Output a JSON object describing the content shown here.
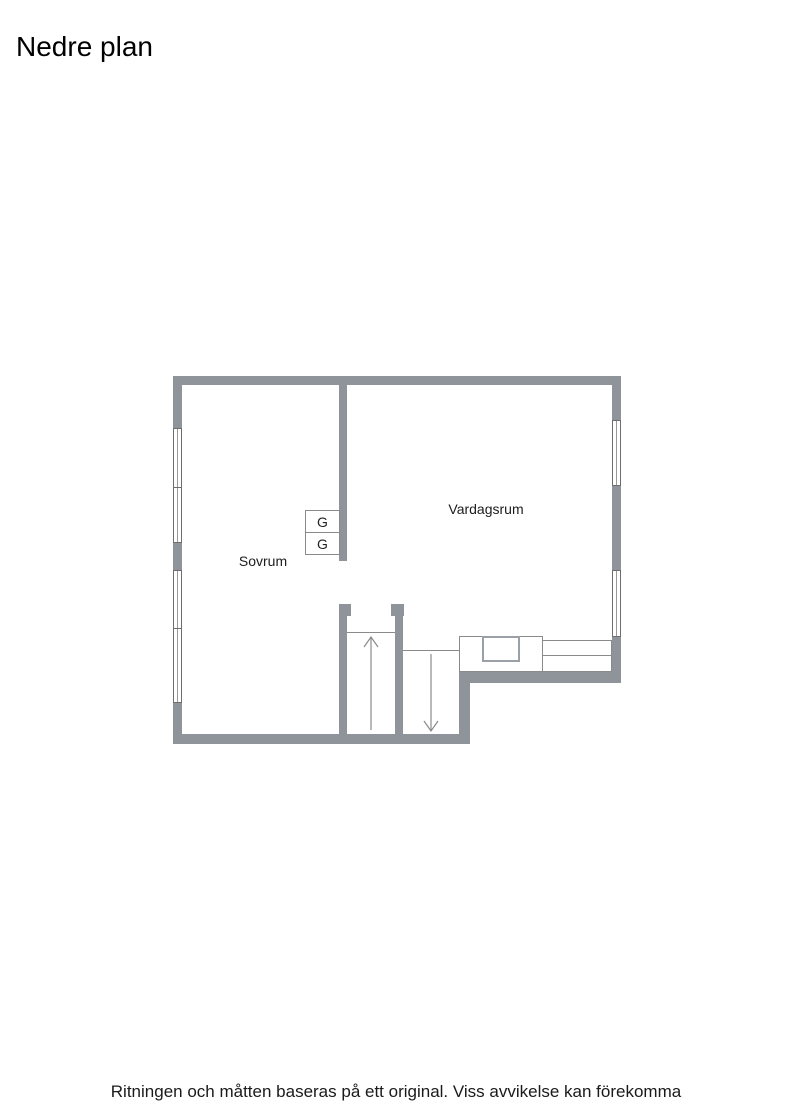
{
  "page": {
    "title": "Nedre plan",
    "disclaimer": "Ritningen och måtten baseras på ett original. Viss avvikelse kan förekomma"
  },
  "floorplan": {
    "rooms": [
      {
        "name": "Sovrum"
      },
      {
        "name": "Vardagsrum"
      }
    ],
    "closets": [
      {
        "label": "G"
      },
      {
        "label": "G"
      }
    ],
    "stairs": {
      "up_arrow_icon": "stairs-up-arrow",
      "down_arrow_icon": "stairs-down-arrow"
    },
    "colors": {
      "wall": "#8e949a",
      "fixture_line": "#8a8a8a",
      "window_frame": "#6e6e6e",
      "text": "#1a1a1a"
    }
  }
}
